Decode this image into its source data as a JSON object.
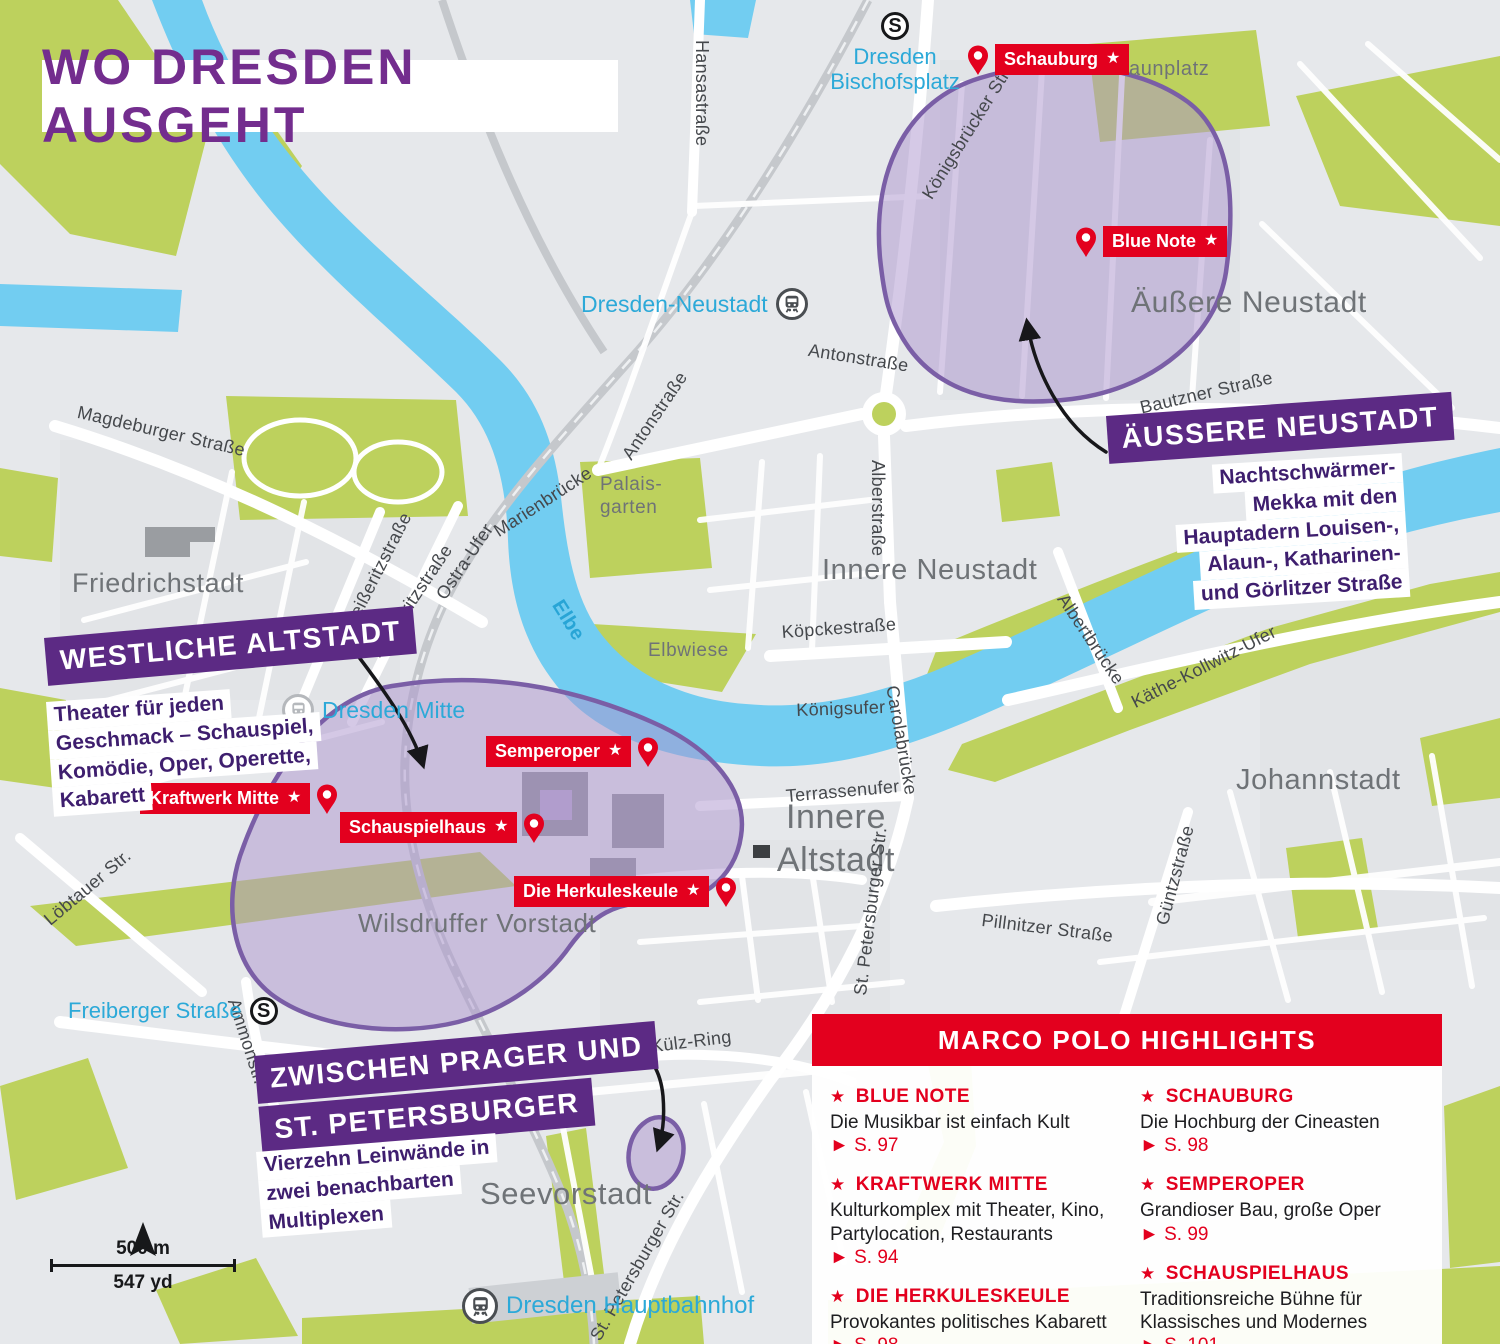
{
  "title": "WO DRESDEN AUSGEHT",
  "colors": {
    "accent_red": "#e3001e",
    "banner_purple": "#5c2a84",
    "title_purple": "#732d8e",
    "region_fill": "#ac92cc",
    "region_stroke": "#7a5ea6",
    "water": "#72cdf1",
    "park": "#bdd15d",
    "station_cyan": "#2ca9d8"
  },
  "icons": {
    "star": "★",
    "page_arrow": "►",
    "s_symbol": "S"
  },
  "regions": [
    {
      "banner_lines": [
        "ÄUSSERE NEUSTADT"
      ],
      "desc_lines": [
        "Nachtschwärmer-",
        "Mekka mit den",
        "Hauptadern Louisen-,",
        "Alaun-, Katharinen-",
        "und Görlitzer Straße"
      ]
    },
    {
      "banner_lines": [
        "WESTLICHE ALTSTADT"
      ],
      "desc_lines": [
        "Theater für jeden",
        "Geschmack – Schauspiel,",
        "Komödie, Oper, Operette,",
        "Kabarett"
      ]
    },
    {
      "banner_lines": [
        "ZWISCHEN PRAGER UND",
        "ST. PETERSBURGER"
      ],
      "desc_lines": [
        "Vierzehn Leinwände in",
        "zwei benachbarten",
        "Multiplexen"
      ]
    }
  ],
  "pois": {
    "schauburg": "Schauburg",
    "blue_note": "Blue Note",
    "semperoper": "Semperoper",
    "schauspielhaus": "Schauspielhaus",
    "kraftwerk_mitte": "Kraftwerk Mitte",
    "herkuleskeule": "Die Herkuleskeule"
  },
  "stations": {
    "bischofsplatz": "Dresden Bischofsplatz",
    "neustadt": "Dresden-Neustadt",
    "mitte": "Dresden Mitte",
    "freiberger": "Freiberger Straße",
    "hauptbahnhof": "Dresden Hauptbahnhof"
  },
  "districts": {
    "aeussere_neustadt": "Äußere Neustadt",
    "innere_neustadt": "Innere Neustadt",
    "friedrichstadt": "Friedrichstadt",
    "johannstadt": "Johannstadt",
    "wilsdruffer_vorstadt": "Wilsdruffer Vorstadt",
    "seevorstadt": "Seevorstadt",
    "innere_altstadt": "Innere Altstadt",
    "alaunplatz": "Alaunplatz",
    "elbwiese": "Elbwiese",
    "palaisgarten": "Palais-garten"
  },
  "streets": {
    "hansastrasse": "Hansastraße",
    "koenigsbruecker": "Königsbrücker Str.",
    "magdeburger": "Magdeburger Straße",
    "antonstrasse_w": "Antonstraße",
    "antonstrasse_e": "Antonstraße",
    "marienbruecke": "Marienbrücke",
    "weisseritzstrasse": "Weißeritzstraße",
    "koenneritzstrasse": "Könneritzstraße",
    "ostra_ufer": "Ostra-Ufer",
    "alberstrasse": "Alberstraße",
    "koepckestrasse": "Köpckestraße",
    "koenigsufer": "Königsufer",
    "carolabruecke": "Carolabrücke",
    "albertbruecke": "Albertbrücke",
    "kaethe_kollwitz": "Käthe-Kollwitz-Ufer",
    "bautzner": "Bautzner Straße",
    "terrassenufer": "Terrassenufer",
    "st_petersburger_mid": "St. Petersburger Str.",
    "st_petersburger_sued": "St. Petersburger Str.",
    "pillnitzer": "Pillnitzer Straße",
    "guentzstrasse": "Güntzstraße",
    "loebtauer": "Löbtauer Str.",
    "ammonstr": "Ammonstr.",
    "dr_kuelz_ring": "Dr.-Külz-Ring",
    "elbe": "Elbe"
  },
  "highlights": {
    "title": "MARCO POLO HIGHLIGHTS",
    "items": [
      {
        "name": "BLUE NOTE",
        "desc": "Die Musikbar ist einfach Kult",
        "page": "S. 97"
      },
      {
        "name": "KRAFTWERK MITTE",
        "desc": "Kulturkomplex mit Theater, Kino, Partylocation, Restaurants",
        "page": "S. 94"
      },
      {
        "name": "DIE HERKULESKEULE",
        "desc": "Provokantes politisches Kabarett",
        "page": "S. 98"
      },
      {
        "name": "SCHAUBURG",
        "desc": "Die Hochburg der Cineasten",
        "page": "S. 98"
      },
      {
        "name": "SEMPEROPER",
        "desc": "Grandioser Bau, große Oper",
        "page": "S. 99"
      },
      {
        "name": "SCHAUSPIELHAUS",
        "desc": "Traditionsreiche Bühne für Klassisches und Modernes",
        "page": "S. 101"
      }
    ]
  },
  "scale": {
    "metric": "500 m",
    "imperial": "547 yd"
  }
}
